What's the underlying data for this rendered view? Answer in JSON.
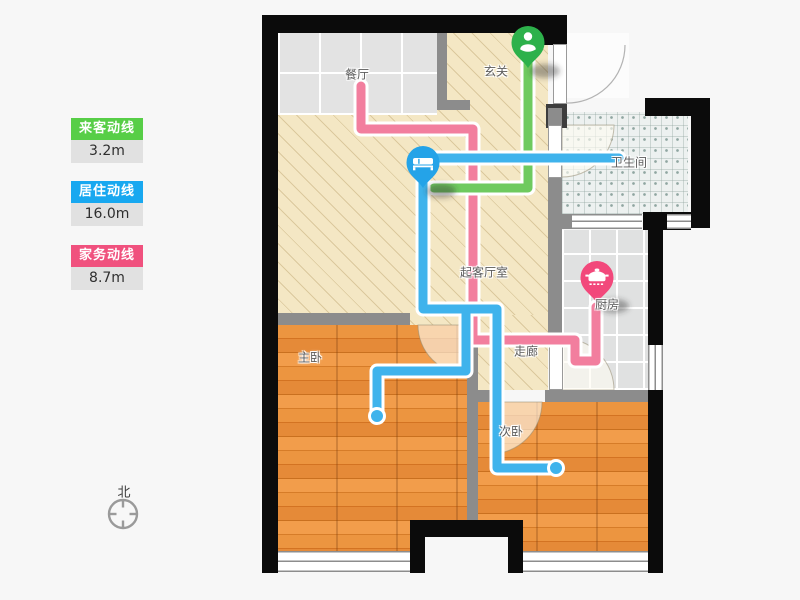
{
  "legend": {
    "items": [
      {
        "label": "来客动线",
        "value": "3.2m",
        "color": "#57ce47"
      },
      {
        "label": "居住动线",
        "value": "16.0m",
        "color": "#18a8f0"
      },
      {
        "label": "家务动线",
        "value": "8.7m",
        "color": "#f0517e"
      }
    ]
  },
  "rooms": {
    "dining": "餐厅",
    "foyer": "玄关",
    "bathroom": "卫生间",
    "kitchen": "厨房",
    "living": "起客厅室",
    "corridor": "走廊",
    "master_bedroom": "主卧",
    "second_bedroom": "次卧"
  },
  "compass": {
    "north_label": "北"
  },
  "lines": {
    "guest": {
      "name": "来客动线",
      "length": "3.2m",
      "color": "#6fca5f"
    },
    "resident": {
      "name": "居住动线",
      "length": "16.0m",
      "color": "#3fb3ec"
    },
    "housework": {
      "name": "家务动线",
      "length": "8.7m",
      "color": "#f27e9e"
    }
  },
  "pins": {
    "entrance_icon": "person-icon",
    "bedroom_icon": "bed-icon",
    "kitchen_icon": "pot-icon"
  }
}
